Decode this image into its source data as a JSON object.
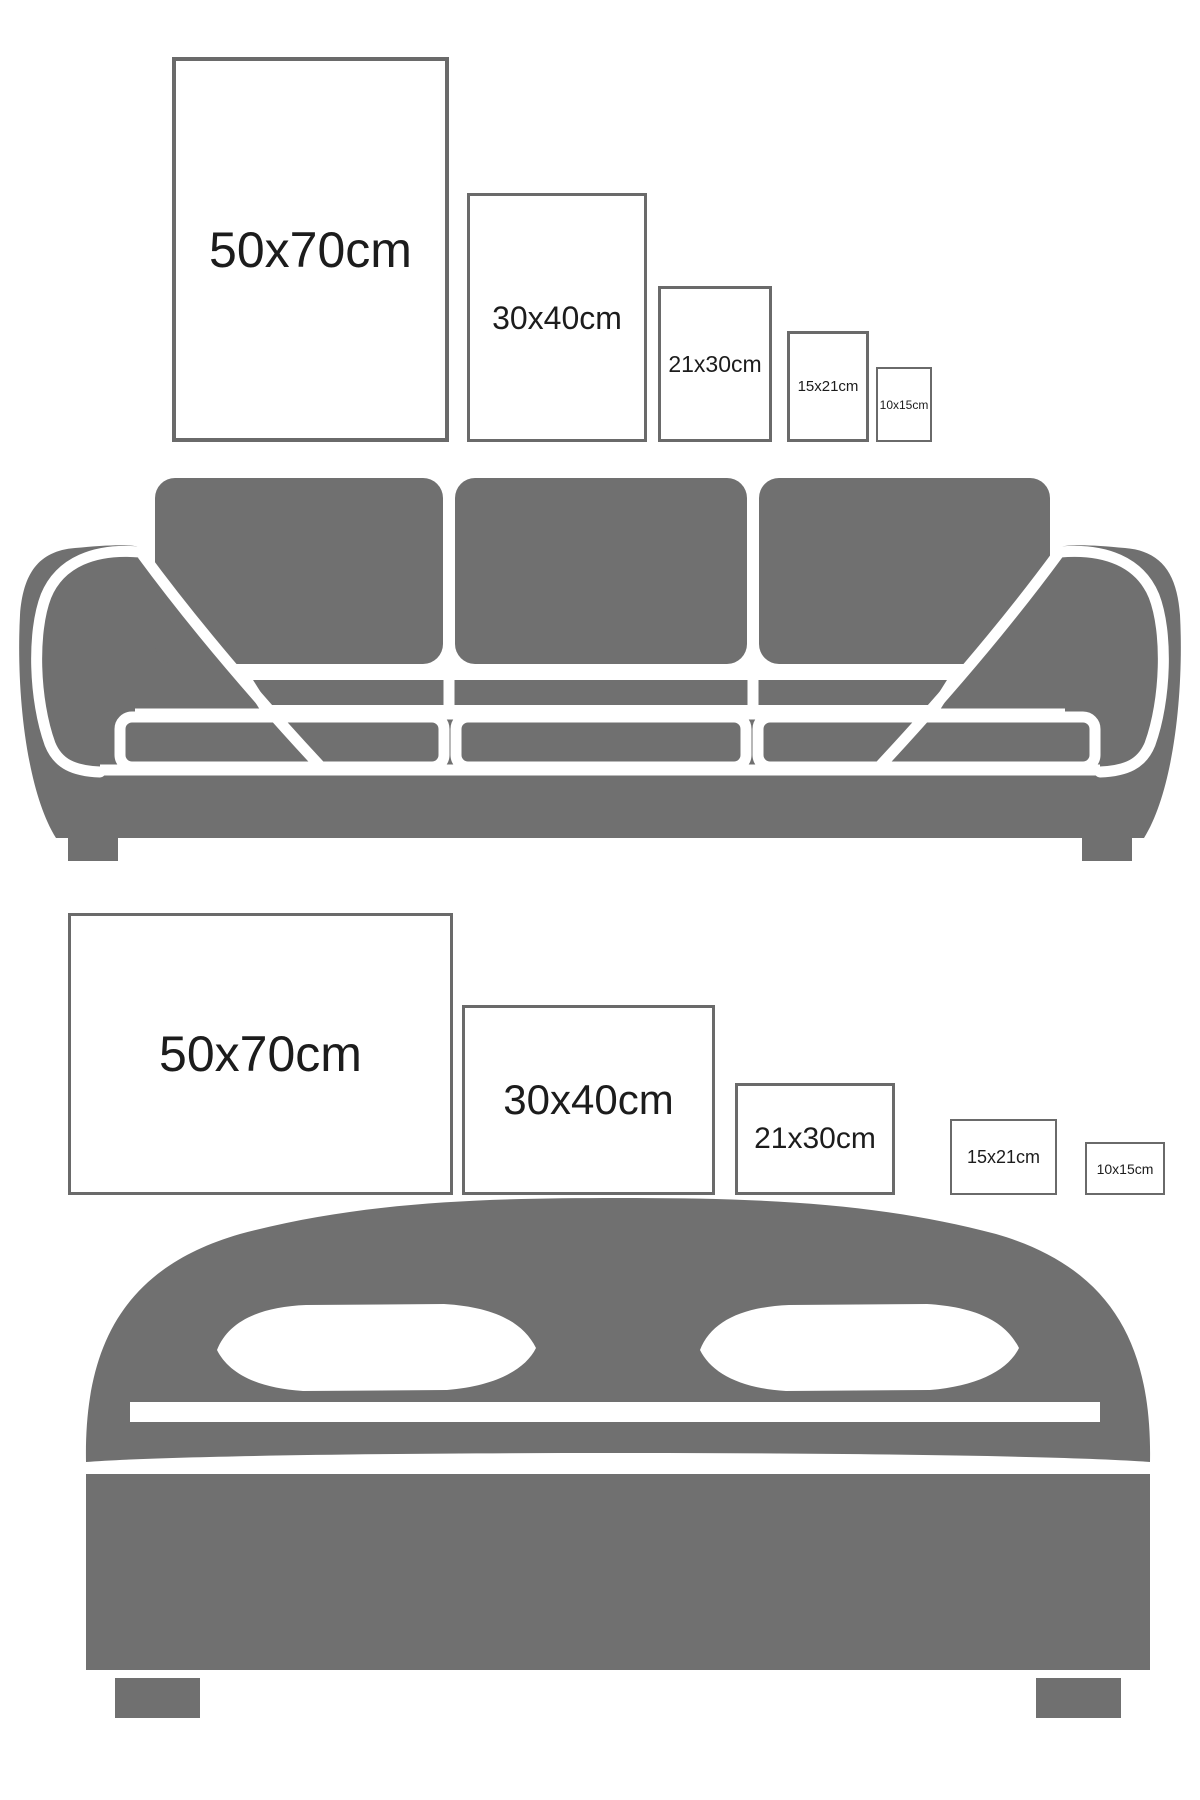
{
  "colors": {
    "background": "#ffffff",
    "furniture_gray": "#707070",
    "frame_border": "#6a6a6a",
    "label_text": "#1c1c1c"
  },
  "sofa_wall": {
    "furniture_icon": "sofa-icon",
    "orientation": "portrait",
    "frames": [
      {
        "label": "50x70cm"
      },
      {
        "label": "30x40cm"
      },
      {
        "label": "21x30cm"
      },
      {
        "label": "15x21cm"
      },
      {
        "label": "10x15cm"
      }
    ]
  },
  "bed_wall": {
    "furniture_icon": "bed-icon",
    "orientation": "landscape",
    "frames": [
      {
        "label": "50x70cm"
      },
      {
        "label": "30x40cm"
      },
      {
        "label": "21x30cm"
      },
      {
        "label": "15x21cm"
      },
      {
        "label": "10x15cm"
      }
    ]
  }
}
